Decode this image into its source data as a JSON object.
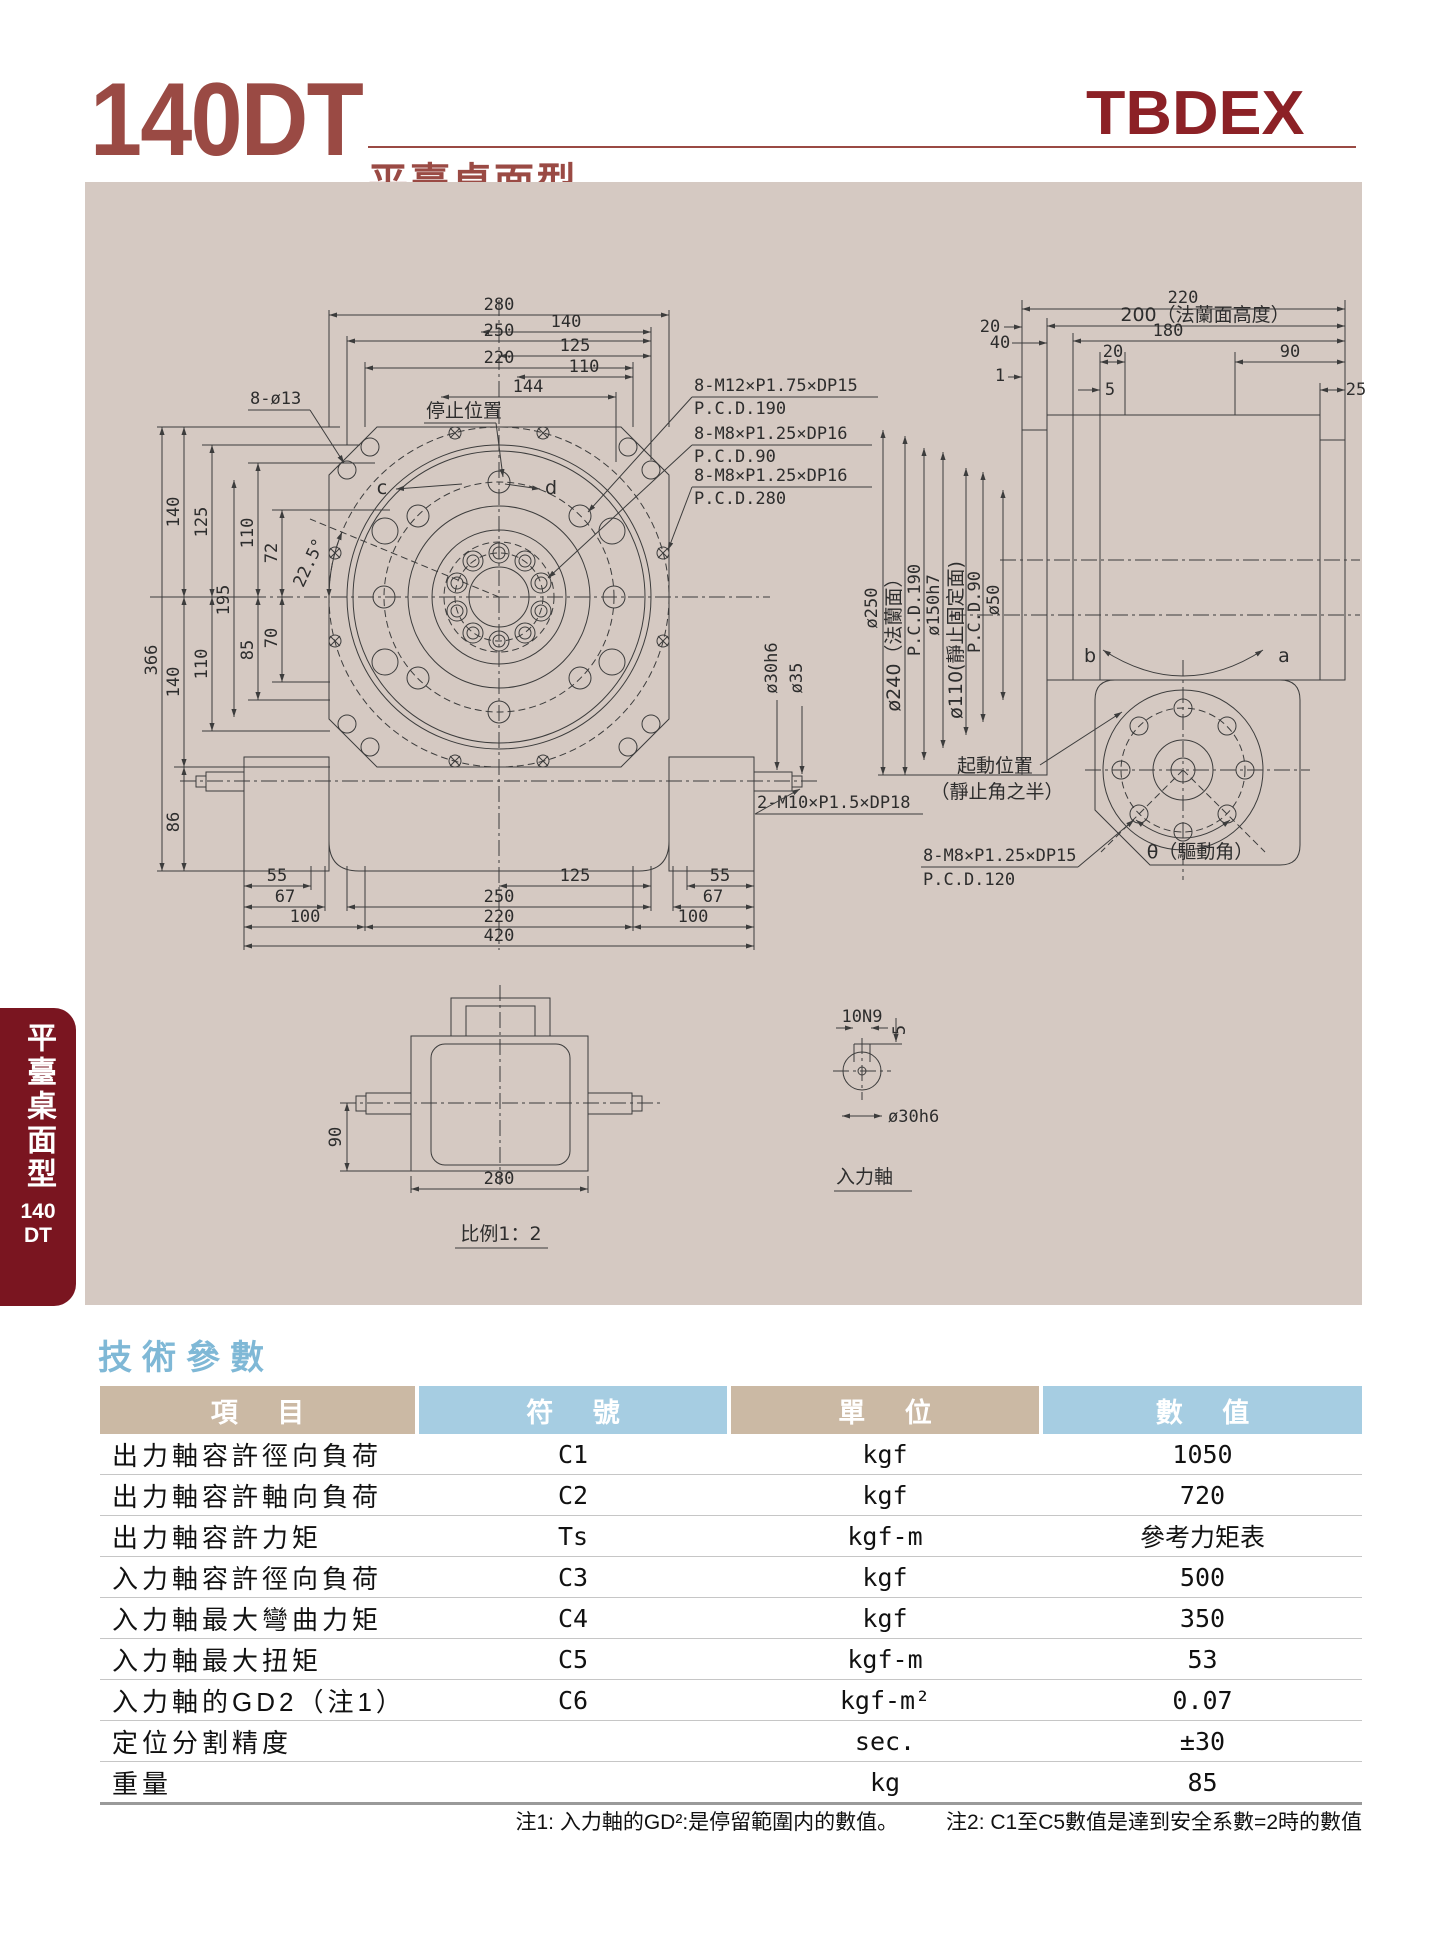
{
  "page": {
    "model": "140DT",
    "subtitle": "平臺桌面型",
    "logo": "TBDEX"
  },
  "sidebar": {
    "vertical_label": "平臺桌面型",
    "model_line1": "140",
    "model_line2": "DT"
  },
  "drawing": {
    "front": {
      "top": [
        "280",
        "250",
        "220",
        "140",
        "125",
        "110",
        "144"
      ],
      "left_upper": [
        "366",
        "140",
        "125",
        "110",
        "72",
        "195",
        "22.5°"
      ],
      "left_lower": [
        "140",
        "110",
        "85",
        "70",
        "86"
      ],
      "bottom": [
        "55",
        "67",
        "100",
        "125",
        "250",
        "220",
        "420",
        "55",
        "67",
        "100"
      ],
      "labels": {
        "holes": "8-ø13",
        "stop": "停止位置",
        "c": "c",
        "d": "d",
        "co1a": "8-M12×P1.75×DP15",
        "co1b": "P.C.D.190",
        "co2a": "8-M8×P1.25×DP16",
        "co2b": "P.C.D.90",
        "co3a": "8-M8×P1.25×DP16",
        "co3b": "P.C.D.280",
        "co4": "2-M10×P1.5×DP18",
        "sd1": "ø30h6",
        "sd2": "ø35"
      }
    },
    "side": {
      "top": [
        "220",
        "200（法蘭面高度）",
        "180",
        "20",
        "40",
        "20",
        "90",
        "1",
        "5",
        "25"
      ],
      "dia": [
        "ø250",
        "ø240（法蘭面）",
        "P.C.D.190",
        "ø150h7",
        "ø110(靜止固定面)",
        "P.C.D.90",
        "ø50"
      ],
      "labels": {
        "b": "b",
        "a": "a",
        "st1": "起動位置",
        "st2": "（靜止角之半）",
        "co5a": "8-M8×P1.25×DP15",
        "co5b": "P.C.D.120",
        "theta": "θ（驅動角）"
      }
    },
    "bottom_view": {
      "h": "90",
      "w": "280",
      "caption": "比例1：2"
    },
    "shaft_view": {
      "key": "10N9",
      "depth": "5",
      "dia": "ø30h6",
      "caption": "入力軸"
    }
  },
  "section": {
    "title": "技術參數"
  },
  "table": {
    "headers": [
      "項 目",
      "符 號",
      "單 位",
      "數 值"
    ],
    "rows": [
      [
        "出力軸容許徑向負荷",
        "C1",
        "kgf",
        "1050"
      ],
      [
        "出力軸容許軸向負荷",
        "C2",
        "kgf",
        "720"
      ],
      [
        "出力軸容許力矩",
        "Ts",
        "kgf-m",
        "參考力矩表"
      ],
      [
        "入力軸容許徑向負荷",
        "C3",
        "kgf",
        "500"
      ],
      [
        "入力軸最大彎曲力矩",
        "C4",
        "kgf",
        "350"
      ],
      [
        "入力軸最大扭矩",
        "C5",
        "kgf-m",
        "53"
      ],
      [
        "入力軸的GD2（注1）",
        "C6",
        "kgf-m²",
        "0.07"
      ],
      [
        "定位分割精度",
        "",
        "sec.",
        "±30"
      ],
      [
        "重量",
        "",
        "kg",
        "85"
      ]
    ],
    "note1": "注1: 入力軸的GD²:是停留範圍内的數值。",
    "note2": "注2: C1至C5數值是達到安全系數=2時的數值"
  },
  "colors": {
    "title_red": "#9a4a44",
    "logo_red": "#8c2126",
    "tab_maroon": "#7a1520",
    "panel_beige": "#d5c9c2",
    "section_blue": "#7fb8d6",
    "header_tan": "#cbb9a4",
    "header_blue": "#a6cde2",
    "line": "#3c3c3c"
  }
}
